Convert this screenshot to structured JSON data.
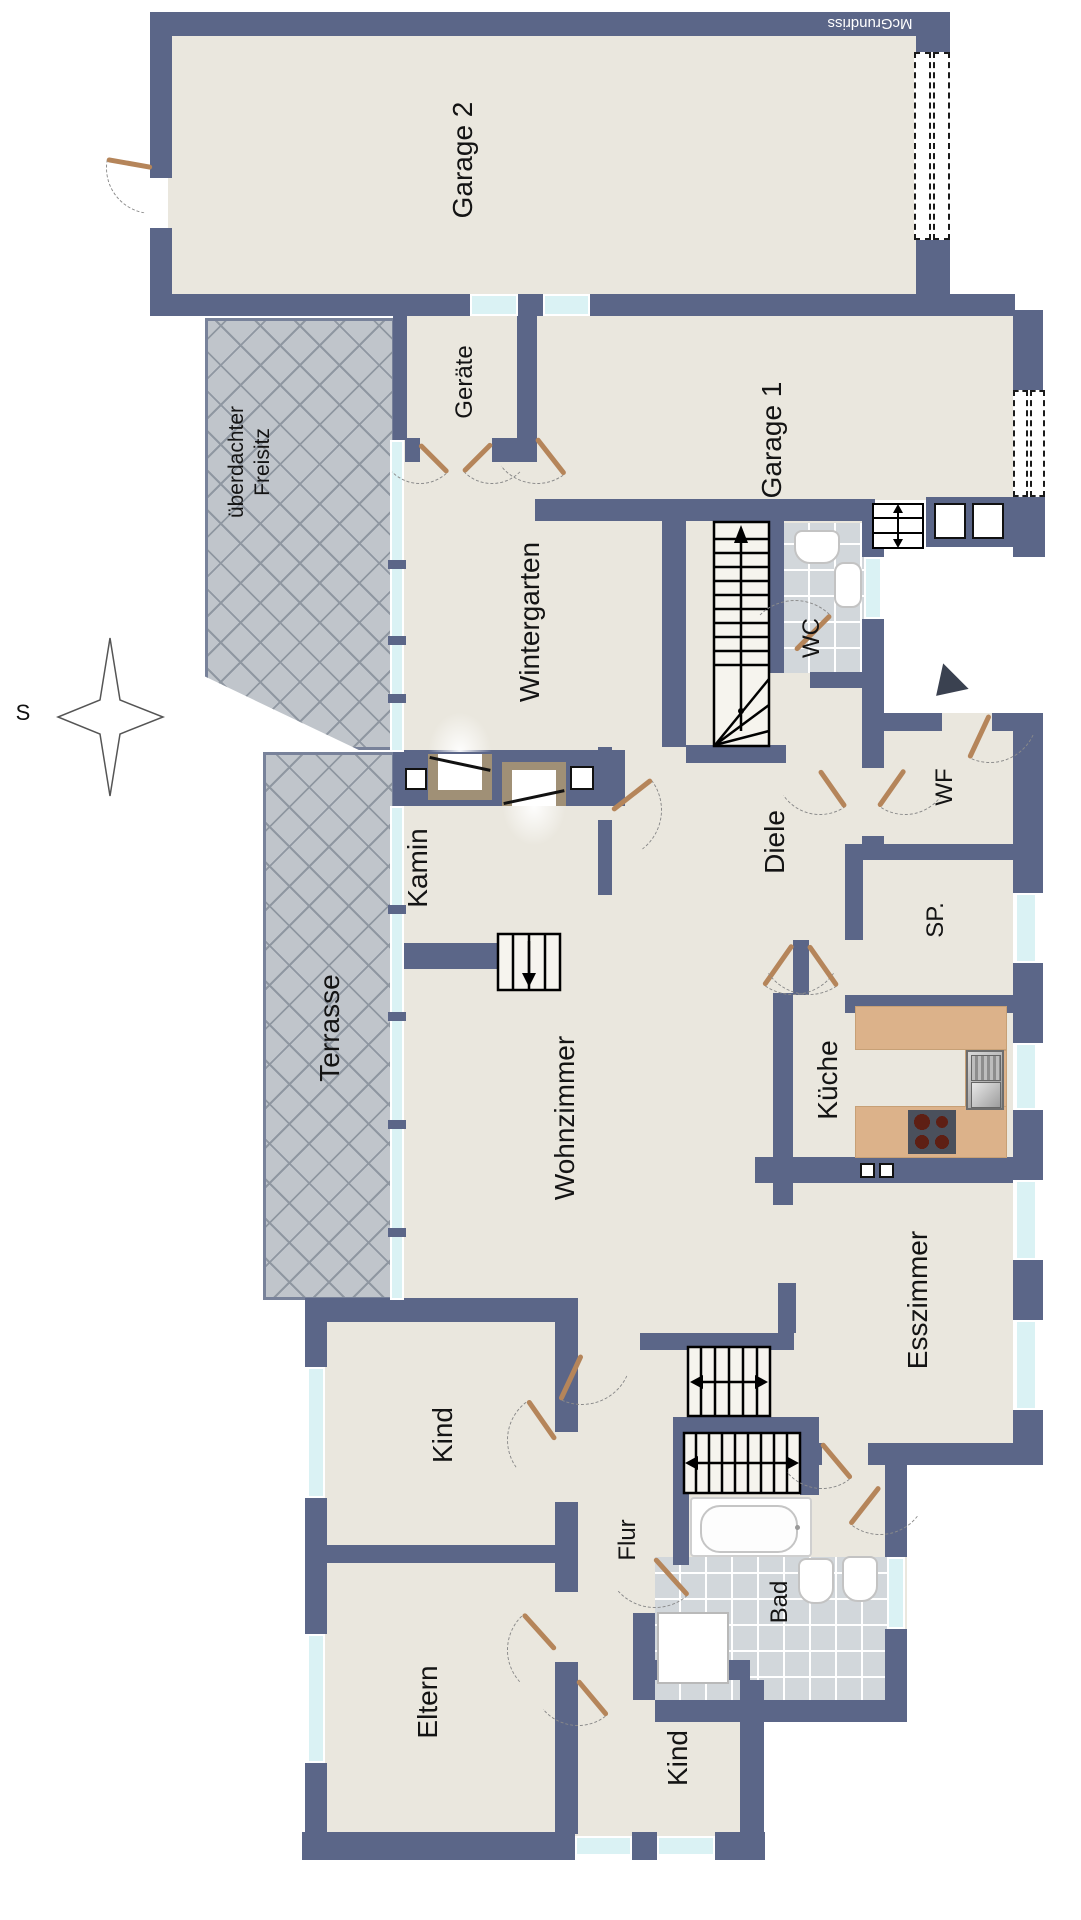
{
  "watermark": "McGrundriss",
  "compass": {
    "letter": "S"
  },
  "rooms": {
    "garage2": "Garage 2",
    "geraete": "Geräte",
    "garage1": "Garage 1",
    "freisitz_line1": "überdachter",
    "freisitz_line2": "Freisitz",
    "wintergarten": "Wintergarten",
    "wc": "WC",
    "diele": "Diele",
    "wf": "WF",
    "sp": "SP.",
    "kamin": "Kamin",
    "terrasse": "Terrasse",
    "kueche": "Küche",
    "wohnzimmer": "Wohnzimmer",
    "esszimmer": "Esszimmer",
    "kind_mitte": "Kind",
    "flur": "Flur",
    "bad": "Bad",
    "eltern": "Eltern",
    "kind_unten": "Kind"
  },
  "colors": {
    "wall": "#5b6688",
    "floor": "#eae7de",
    "tile_outdoor": "#c0c5cb",
    "tile_line": "#8f97a1",
    "tile_bath": "#d2d7db",
    "glass": "#daf2f4",
    "door": "#b5855a",
    "counter": "#dcb28a",
    "stove": "#4a505c",
    "burner": "#5e1f14",
    "label": "#141414"
  }
}
